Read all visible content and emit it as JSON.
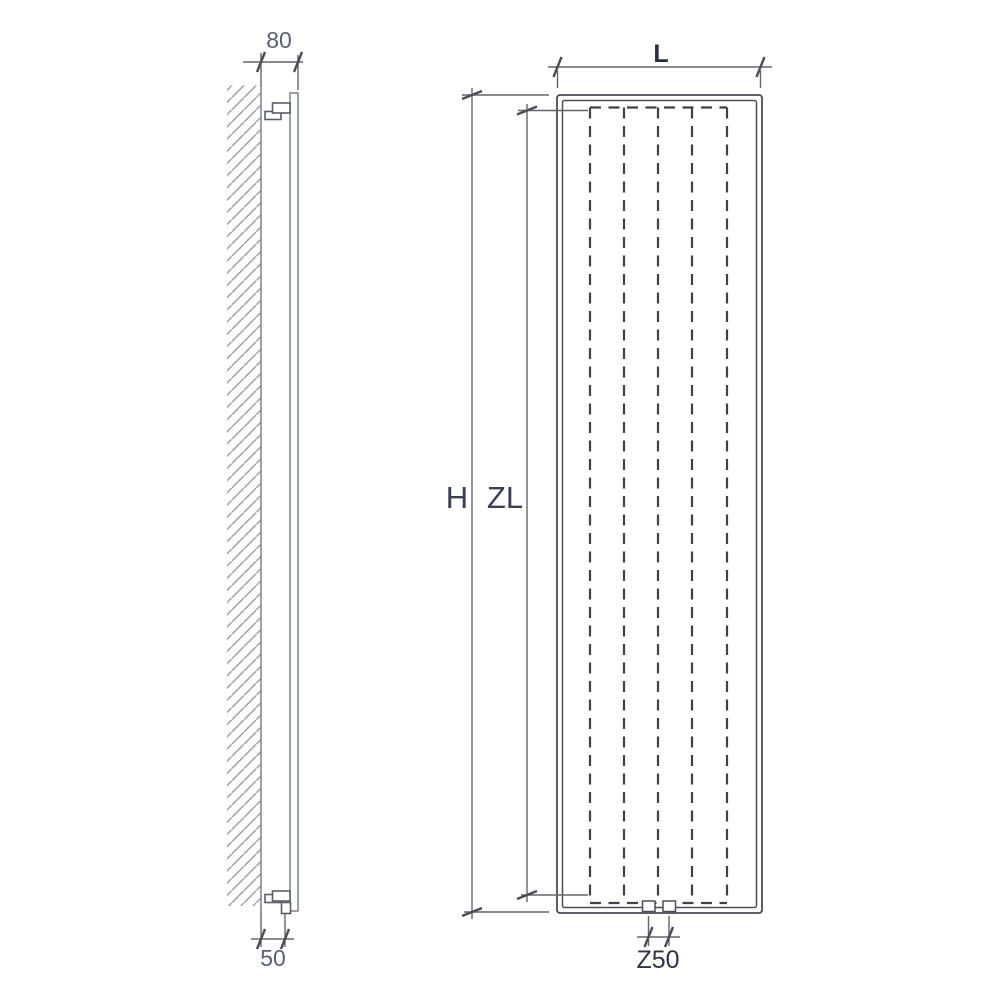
{
  "drawing": {
    "side_view": {
      "depth_dimension_label": "80",
      "bottom_offset_dimension_label": "50"
    },
    "front_view": {
      "width_dimension_label": "L",
      "height_dimension_label": "H",
      "element_length_dimension_label": "ZL",
      "connection_spacing_dimension_label": "Z50"
    },
    "colors": {
      "background": "#ffffff",
      "outline_ink": "#494c55",
      "dashed_fin_ink": "#3f424b",
      "dimension_ink": "#63666d",
      "wall_ink": "#7d828b",
      "hatch_ink": "#949aa4",
      "label_gray": "#596170",
      "label_dark": "#2e3347"
    }
  }
}
